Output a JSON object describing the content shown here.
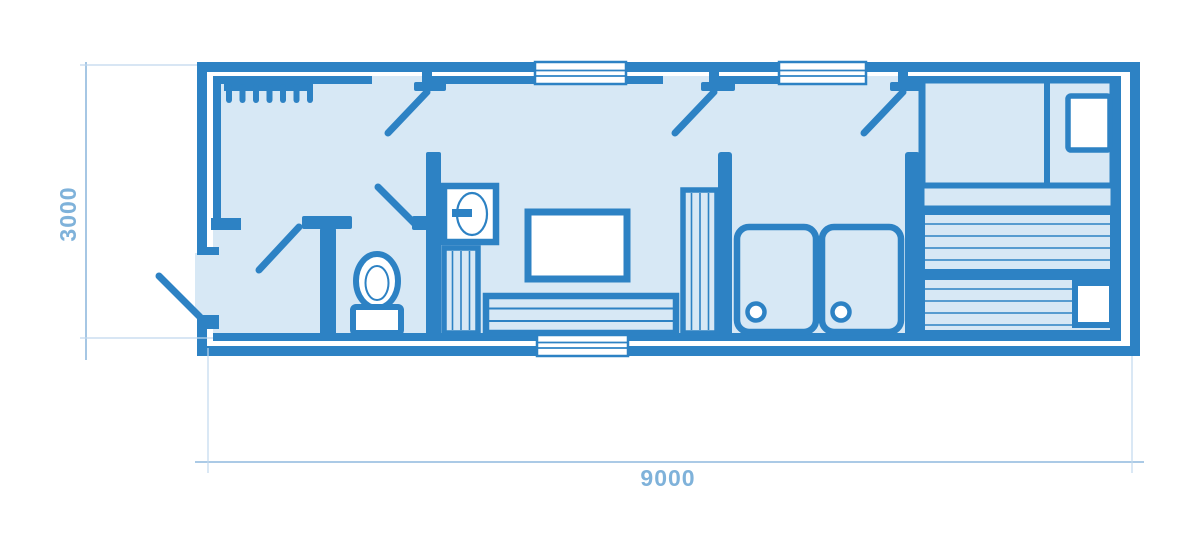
{
  "page": {
    "type": "architectural-floor-plan",
    "background": "#ffffff"
  },
  "dimension_labels": {
    "horizontal": "9000",
    "vertical": "3000"
  },
  "building": {
    "length_mm": 9000,
    "width_mm": 3000,
    "windows_top": 2,
    "windows_bottom": 1,
    "entry_doors_top": 3,
    "entry_door_left": 1
  },
  "fixtures": [
    "coat-rack",
    "toilet",
    "washbasin",
    "striped-cabinet",
    "table",
    "slatted-bench",
    "locker-unit",
    "shower-tray-left",
    "shower-tray-right",
    "bed",
    "pillow",
    "bed-step",
    "sauna-bench-upper",
    "sauna-bench-lower",
    "stove"
  ],
  "colors": {
    "wall": "#2d82c4",
    "floor": "#d7e8f5",
    "furniture_white": "#ffffff",
    "dimension_line": "#8fb9dd",
    "extension_line": "#c0d8ee",
    "dimension_text": "#7fb2da"
  }
}
